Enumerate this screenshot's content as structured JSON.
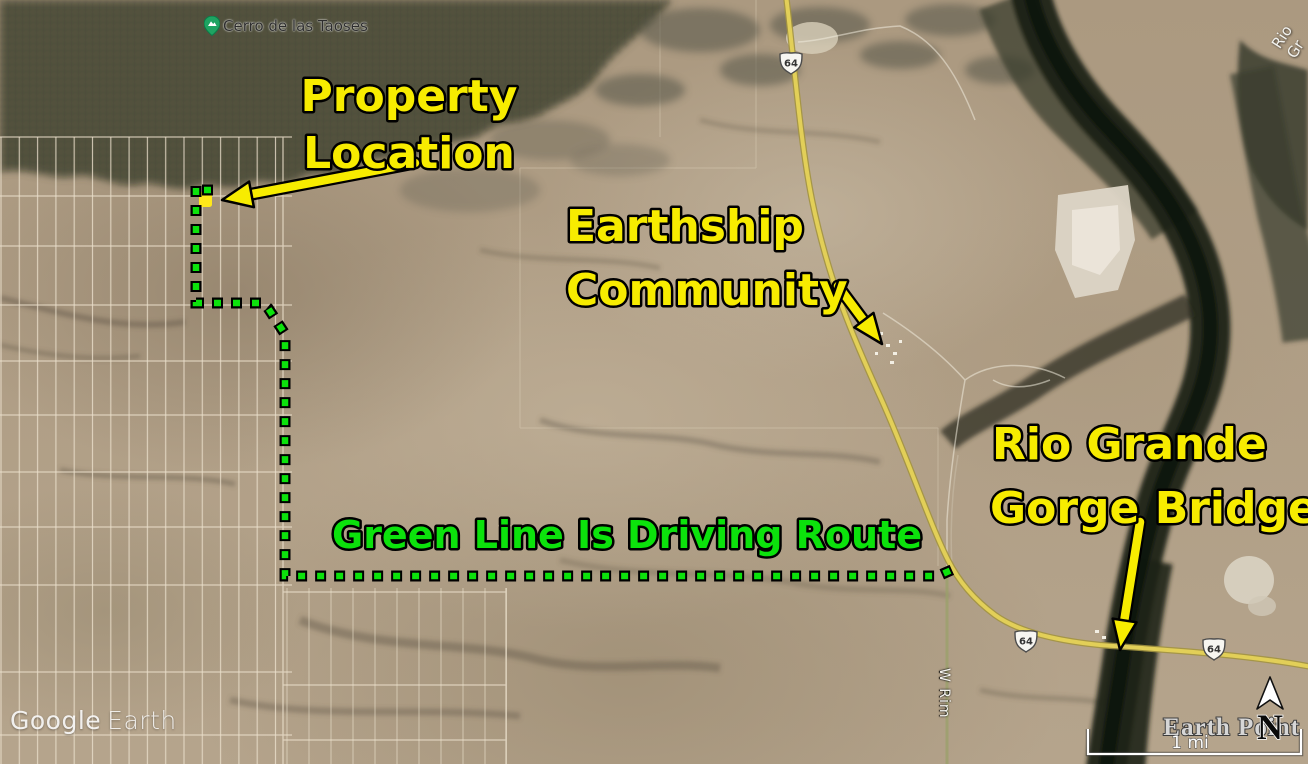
{
  "annotations": {
    "property": {
      "line1": "Property",
      "line2": "Location"
    },
    "earthship": {
      "line1": "Earthship",
      "line2": "Community"
    },
    "bridge": {
      "line1": "Rio Grande",
      "line2": "Gorge Bridge"
    },
    "route_note": "Green Line Is Driving Route"
  },
  "map_labels": {
    "peak": "Cerro de las Taoses",
    "river": "Rio Gr",
    "road_vertical": "W Rim",
    "highway_shield": "64"
  },
  "hud": {
    "watermark_word1": "Google",
    "watermark_word2": "Earth",
    "attribution": "Earth Point",
    "compass_letter": "N",
    "scale_text": "1 mi"
  },
  "colors": {
    "annotation_yellow": "#f7ec00",
    "route_green": "#0ce20c",
    "highway_yellow": "#e2cf58",
    "pin_green": "#1ea362",
    "gorge_dark": "#1e2118"
  }
}
